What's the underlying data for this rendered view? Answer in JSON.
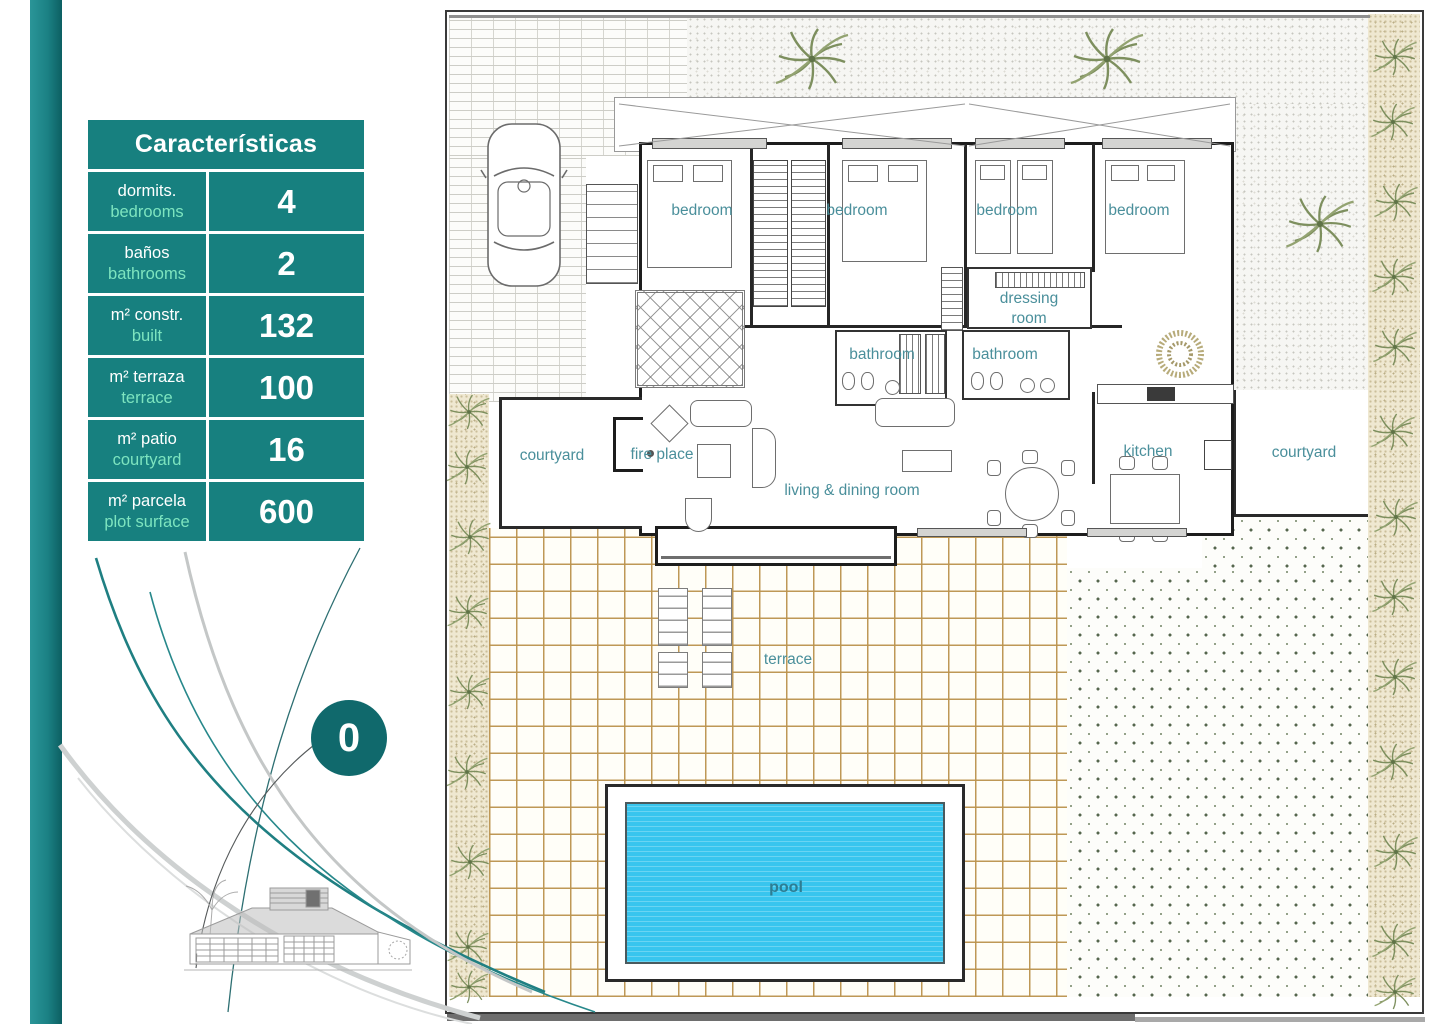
{
  "characteristics_table": {
    "title": "Características",
    "rows": [
      {
        "label_primary": "dormits.",
        "label_secondary": "bedrooms",
        "value": "4"
      },
      {
        "label_primary": "baños",
        "label_secondary": "bathrooms",
        "value": "2"
      },
      {
        "label_primary": "m² constr.",
        "label_secondary": "built",
        "value": "132"
      },
      {
        "label_primary": "m² terraza",
        "label_secondary": "terrace",
        "value": "100"
      },
      {
        "label_primary": "m² patio",
        "label_secondary": "courtyard",
        "value": "16"
      },
      {
        "label_primary": "m² parcela",
        "label_secondary": "plot surface",
        "value": "600"
      }
    ]
  },
  "floor_badge": {
    "value": "0"
  },
  "footnote_mark": "!",
  "plan_labels": {
    "bedroom_1": "bedroom",
    "bedroom_2": "bedroom",
    "bedroom_3": "bedroom",
    "bedroom_4": "bedroom",
    "dressing_room": "dressing room",
    "bathroom_1": "bathroom",
    "bathroom_2": "bathroom",
    "courtyard_left": "courtyard",
    "courtyard_right": "courtyard",
    "fire_place": "fire place",
    "living_dining": "living & dining room",
    "kitchen": "kitchen",
    "terrace": "terrace",
    "pool": "pool"
  },
  "colors": {
    "accent_teal": "#17807F",
    "mint_text": "#7DE4BF",
    "room_label_teal": "#4A8F9B",
    "pool_water": "#38C5EE",
    "terrace_grid": "#BB934D",
    "badge_teal": "#10696C"
  }
}
